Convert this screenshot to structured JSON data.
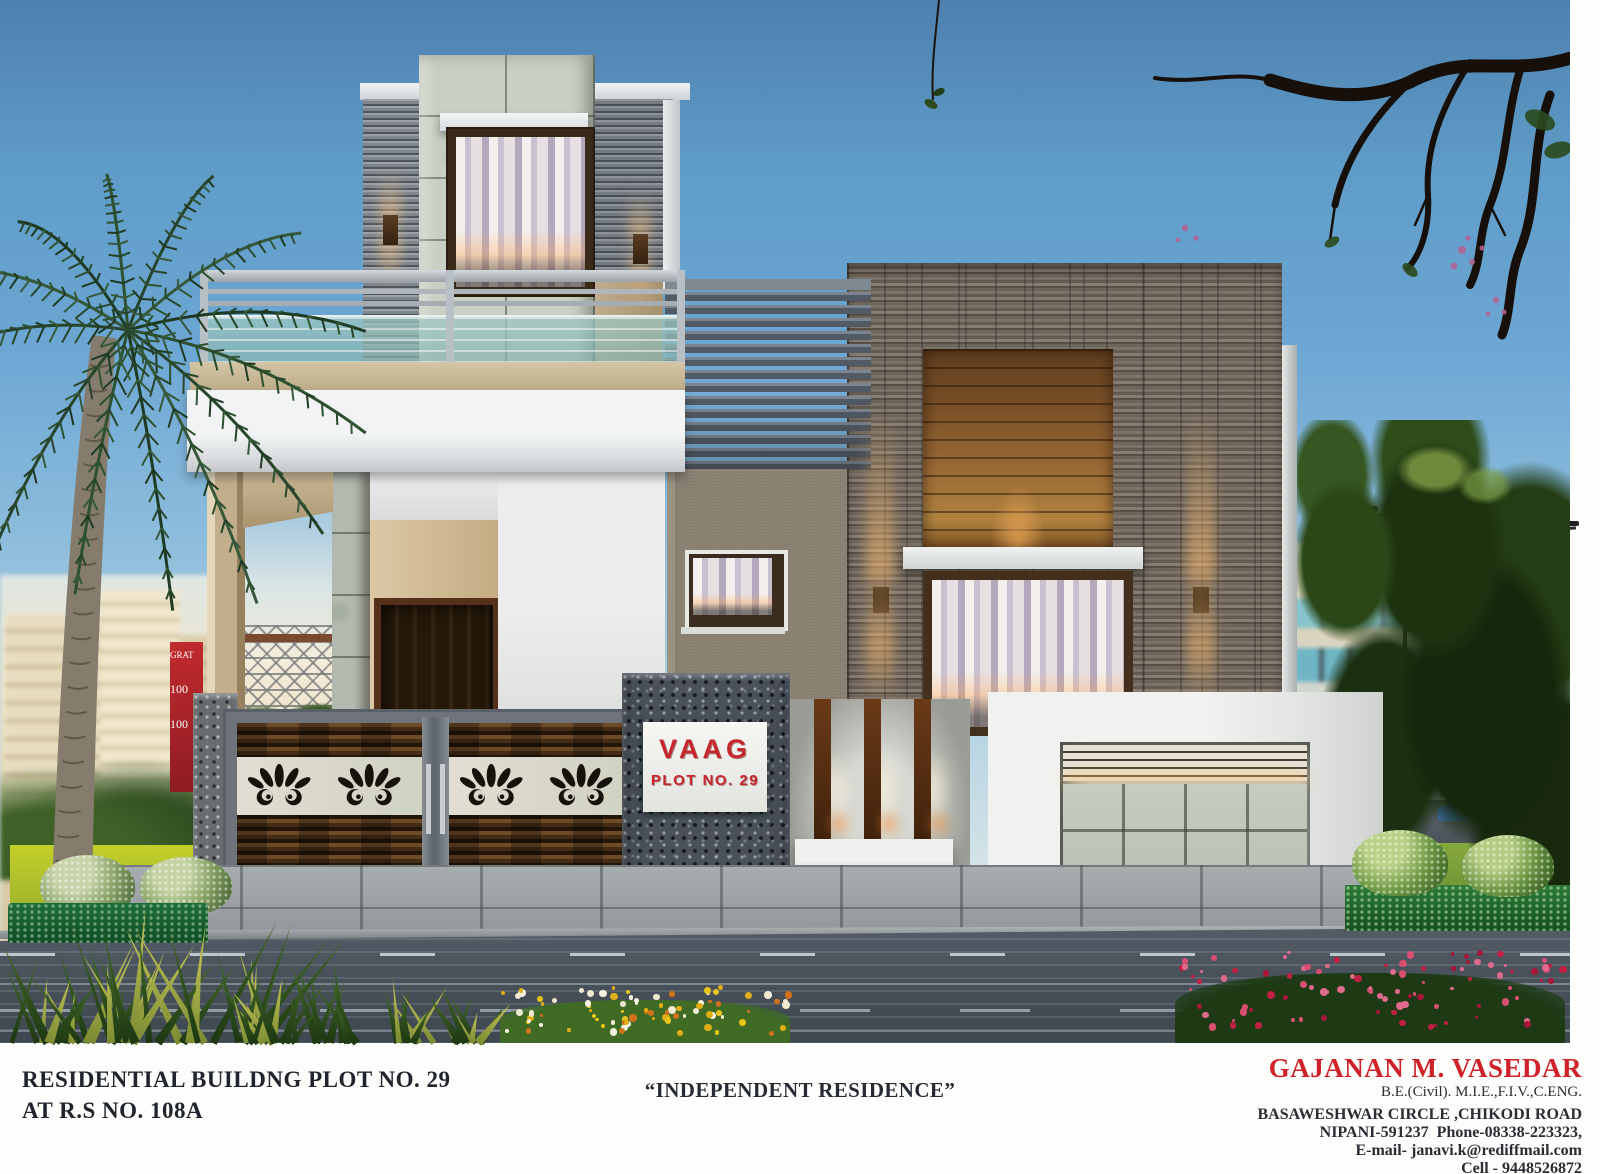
{
  "scene": {
    "signboard": {
      "brand": "VAAG",
      "plot_label": "PLOT NO. 29"
    },
    "billboard": {
      "line1": "GRAT",
      "line2": "100",
      "line3": "100"
    }
  },
  "caption": {
    "title_line1": "RESIDENTIAL BUILDNG PLOT NO. 29",
    "title_line2": "AT R.S NO. 108A",
    "subtitle": "“INDEPENDENT RESIDENCE”",
    "architect_name": "GAJANAN M. VASEDAR",
    "architect_credentials": "B.E.(Civil). M.I.E.,F.I.V.,C.ENG.",
    "address_line1": "BASAWESHWAR CIRCLE ,CHIKODI ROAD",
    "address_line2": "NIPANI-591237  Phone-08338-223323,",
    "email": "E-mail- janavi.k@rediffmail.com",
    "cell": "Cell - 9448526872"
  },
  "colors": {
    "accent_red": "#d02028",
    "sign_red": "#c5272d",
    "sky_top": "#4e80ae",
    "stone_gray": "#6e655c",
    "wood_brown": "#8a5a2e",
    "glass_aqua": "#a5cbc5"
  }
}
